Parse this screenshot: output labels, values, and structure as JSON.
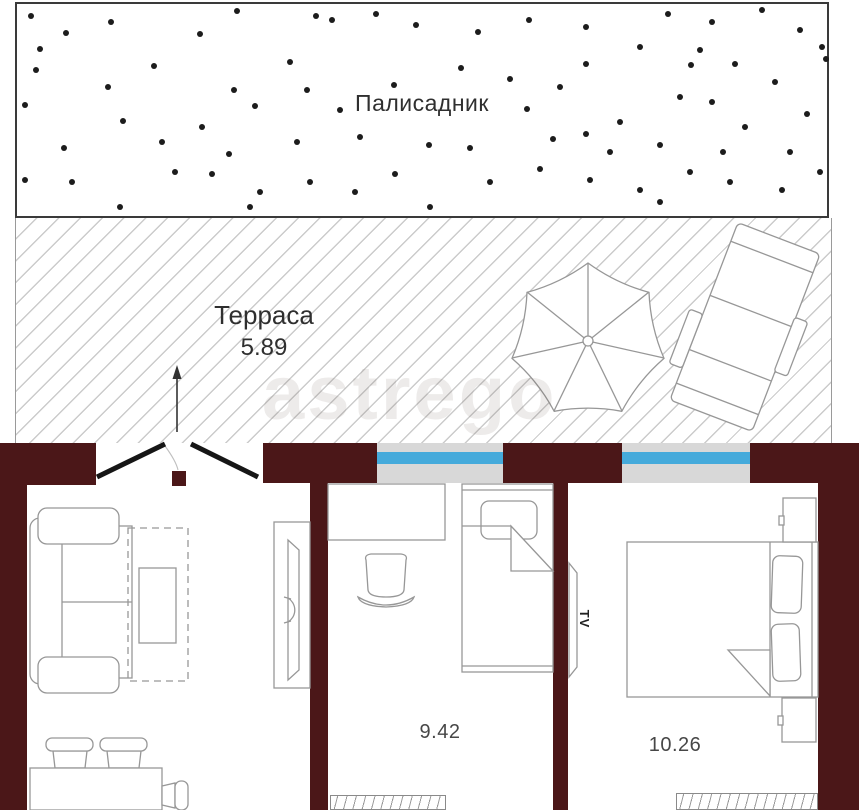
{
  "colors": {
    "wall": "#4b1718",
    "window_glass": "#45aadb",
    "window_frame": "#d8d8d8",
    "hatch_line": "#cbcbcb",
    "dot": "#1c1c1c",
    "text": "#2f2f2f"
  },
  "palisade": {
    "label": "Палисадник",
    "dots": [
      [
        31,
        16
      ],
      [
        66,
        33
      ],
      [
        40,
        49
      ],
      [
        25,
        105
      ],
      [
        36,
        70
      ],
      [
        64,
        148
      ],
      [
        25,
        180
      ],
      [
        72,
        182
      ],
      [
        111,
        22
      ],
      [
        108,
        87
      ],
      [
        123,
        121
      ],
      [
        120,
        207
      ],
      [
        162,
        142
      ],
      [
        154,
        66
      ],
      [
        175,
        172
      ],
      [
        200,
        34
      ],
      [
        202,
        127
      ],
      [
        212,
        174
      ],
      [
        229,
        154
      ],
      [
        237,
        11
      ],
      [
        234,
        90
      ],
      [
        255,
        106
      ],
      [
        250,
        207
      ],
      [
        260,
        192
      ],
      [
        290,
        62
      ],
      [
        297,
        142
      ],
      [
        307,
        90
      ],
      [
        310,
        182
      ],
      [
        316,
        16
      ],
      [
        340,
        110
      ],
      [
        332,
        20
      ],
      [
        355,
        192
      ],
      [
        360,
        137
      ],
      [
        376,
        14
      ],
      [
        394,
        85
      ],
      [
        395,
        174
      ],
      [
        416,
        25
      ],
      [
        429,
        145
      ],
      [
        430,
        207
      ],
      [
        461,
        68
      ],
      [
        470,
        148
      ],
      [
        478,
        32
      ],
      [
        490,
        182
      ],
      [
        510,
        79
      ],
      [
        529,
        20
      ],
      [
        527,
        109
      ],
      [
        540,
        169
      ],
      [
        553,
        139
      ],
      [
        560,
        87
      ],
      [
        586,
        27
      ],
      [
        586,
        64
      ],
      [
        590,
        180
      ],
      [
        586,
        134
      ],
      [
        610,
        152
      ],
      [
        620,
        122
      ],
      [
        640,
        47
      ],
      [
        640,
        190
      ],
      [
        660,
        145
      ],
      [
        668,
        14
      ],
      [
        660,
        202
      ],
      [
        680,
        97
      ],
      [
        691,
        65
      ],
      [
        700,
        50
      ],
      [
        690,
        172
      ],
      [
        712,
        22
      ],
      [
        712,
        102
      ],
      [
        723,
        152
      ],
      [
        730,
        182
      ],
      [
        735,
        64
      ],
      [
        745,
        127
      ],
      [
        762,
        10
      ],
      [
        775,
        82
      ],
      [
        782,
        190
      ],
      [
        790,
        152
      ],
      [
        800,
        30
      ],
      [
        807,
        114
      ],
      [
        820,
        172
      ],
      [
        822,
        47
      ],
      [
        826,
        59
      ]
    ]
  },
  "terrace": {
    "label": "Терраса",
    "area": "5.89"
  },
  "rooms": [
    {
      "area": "9.42"
    },
    {
      "area": "10.26"
    }
  ],
  "tv": {
    "label": "TV"
  },
  "watermark": {
    "text": "astrego"
  }
}
